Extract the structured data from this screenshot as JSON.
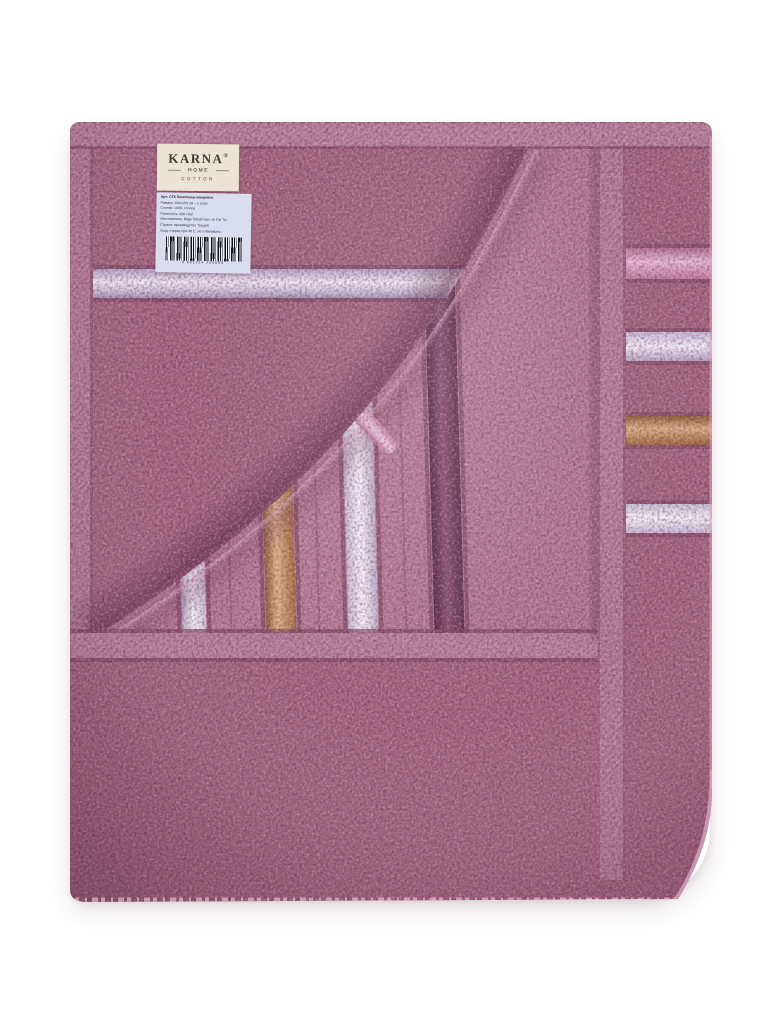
{
  "scene": {
    "type": "product-photo",
    "subject": "Folded mauve terry bath towel with satin stripe border, top corner folded back",
    "background_color": "#ffffff"
  },
  "brand_label": {
    "brand": "KARNA",
    "registered_mark": "®",
    "subtitle": "HOME",
    "material_line": "COTTON",
    "label_color": "#ece4d2"
  },
  "info_label": {
    "label_color": "#dadded",
    "lines": [
      "Арт: СТК Полотенце махровое",
      "Размер: 100х150 см – 1 штук",
      "Состав: 100% хлопок",
      "Плотность: 400 г/м2",
      "Изготовитель: Bilge Tekstil San. ve Dis Tic.",
      "Страна: производство Турция",
      "Уход: стирка при 40 С, не отбеливать"
    ],
    "barcode_digits": "8 681214 200098"
  },
  "towel_colors": {
    "terry_base": "#a2647e",
    "terry_dark_speckle": "#5c2c47",
    "terry_light_speckle": "#edc3d8",
    "edge_band": "#b77e99",
    "hem_band": "#b67e99",
    "left_selvage": "#b07894",
    "right_selvage": "#b27a95",
    "flap_terry": "#b07690",
    "satin_silver": "#e9e5f1",
    "satin_lilac": "#d9cde5",
    "satin_gold": "#bd8a5e",
    "satin_pink": "#cb84ab",
    "satin_plum": "#6d3a58"
  }
}
